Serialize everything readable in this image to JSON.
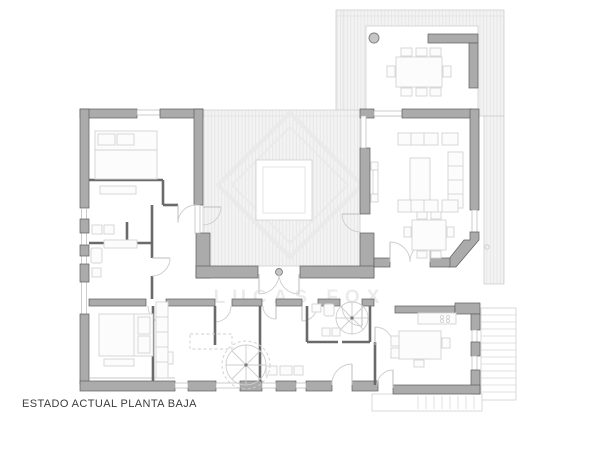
{
  "labels": {
    "title": "ESTADO ACTUAL PLANTA BAJA",
    "watermark": "LUCAS FOX"
  },
  "colors": {
    "wall_fill": "#ababab",
    "wall_stroke": "#5e5e5e",
    "thin_wall": "#6a6a6a",
    "furniture_line": "#d3d3d3",
    "furniture_fill": "#fcfcfc",
    "window_line": "#b8b8b8",
    "arc_line": "#cdcdcd",
    "hatch_bg": "#f3f3f3",
    "hatch_line": "#e4e4e4",
    "edge_line": "#cfcfcf",
    "steps_line": "#d9d9d9",
    "watermark_line": "#eaeaea",
    "watermark_text_color": "#d8d8d8",
    "title_color": "#3c3c3c",
    "background": "#ffffff",
    "column_fill": "#c6c6c6",
    "column_stroke": "#7e7e7e",
    "dash_line": "#cfcfcf"
  }
}
